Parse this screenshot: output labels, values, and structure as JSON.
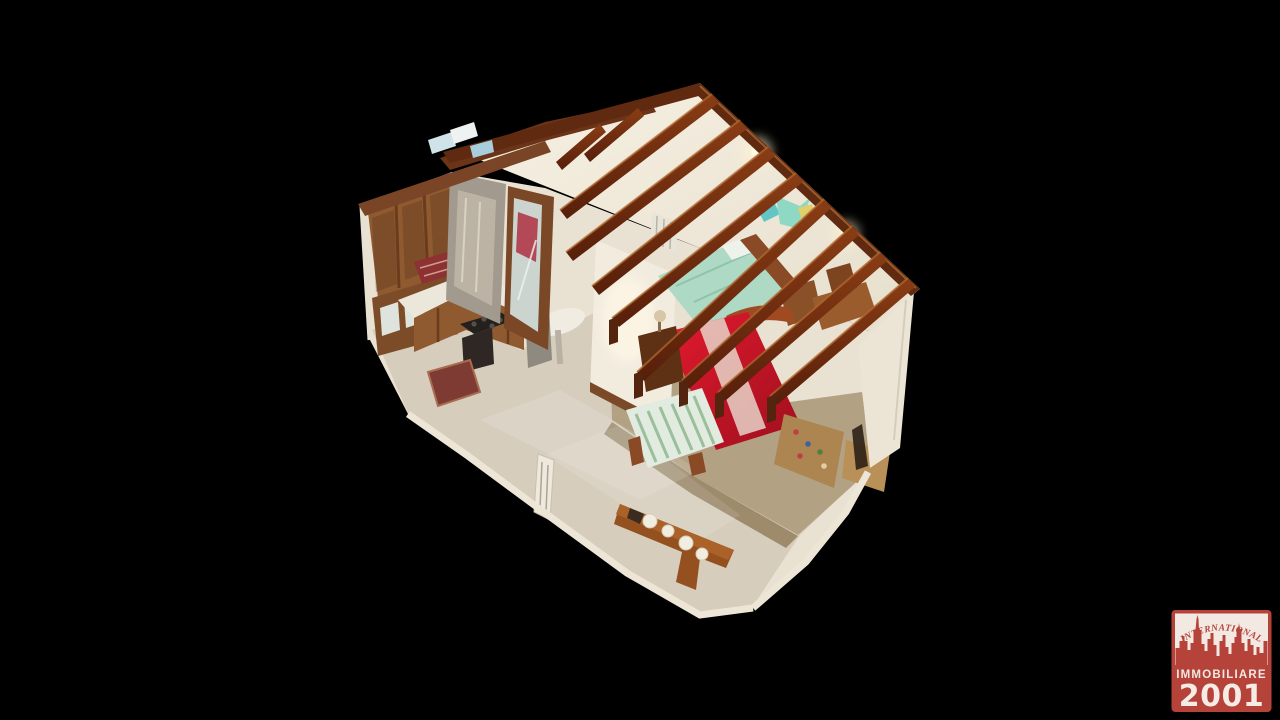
{
  "background_color": "#000000",
  "scene": {
    "view": "3D dollhouse cutaway of an attic apartment (point-cloud 3D scan)",
    "visible_rooms": [
      "kitchen",
      "shower-bathroom",
      "bedroom",
      "dining-area"
    ],
    "furniture": [
      "wood upper cabinets",
      "kitchen counter with cooktop and oven",
      "shower stall",
      "mirrored wardrobe",
      "double bed with red cover",
      "double bed with mint-green cover",
      "table with striped cloth",
      "nightstands",
      "desk and chair",
      "sideboard with white ceramics",
      "exposed wooden roof beams"
    ]
  },
  "watermark": {
    "arc_text": "INTERNATIONAL",
    "band_text": "IMMOBILIARE",
    "year_text": "2001",
    "skyline_icon": "city-skyline",
    "red": "#b5433a",
    "white": "#f2e9e2"
  },
  "palette": {
    "roof": "#efe8da",
    "beam": "#7c3512",
    "wall": "#eae2d2",
    "floor_light": "#d6cdbd",
    "floor_tan": "#b3a184",
    "red_bed": "#cf1626",
    "green_bed": "#abd9c4",
    "cabinet_wood": "#8f5a30"
  }
}
